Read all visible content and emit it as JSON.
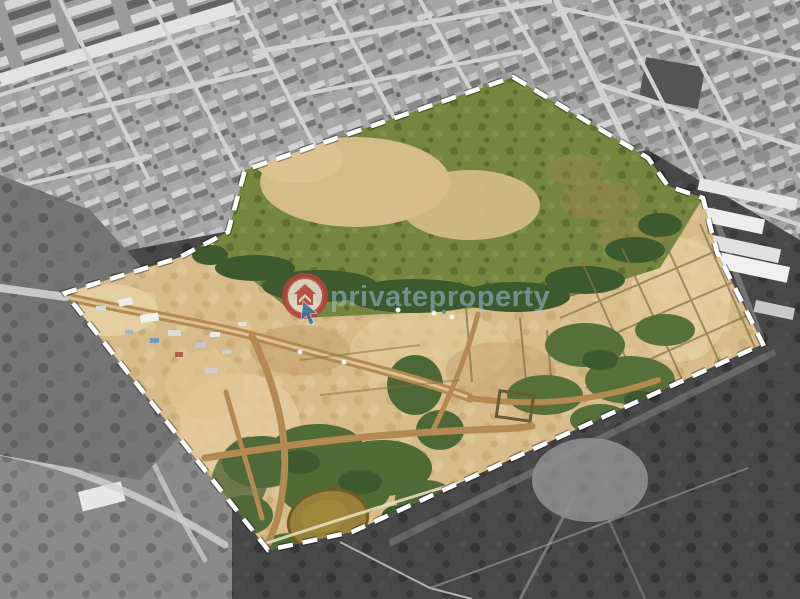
{
  "watermark": {
    "text": "privateproperty",
    "logo_name": "privateproperty-logo"
  },
  "boundary": {
    "points": "513,77 648,158 668,186 703,198 717,252 763,344 352,532 268,550 65,293 178,258 228,232 245,170",
    "dash_pattern": "15 10"
  },
  "palette": {
    "boundary_white": "#ffffff",
    "sand": "#d7bb8a",
    "sand_light": "#e6d0a2",
    "sand_dark": "#c2a06c",
    "field_green": "#75863f",
    "dark_green": "#3c5a2e",
    "pond": "#97803a",
    "urban_gray": "#a6a6a6",
    "scrub_dark": "#474747",
    "dirt_road": "#b28a52",
    "watermark_blue": "#a5c9e3",
    "logo_red": "#b5433a",
    "logo_cursor_blue": "#3e6f8e",
    "logo_face": "#ece4d2"
  }
}
